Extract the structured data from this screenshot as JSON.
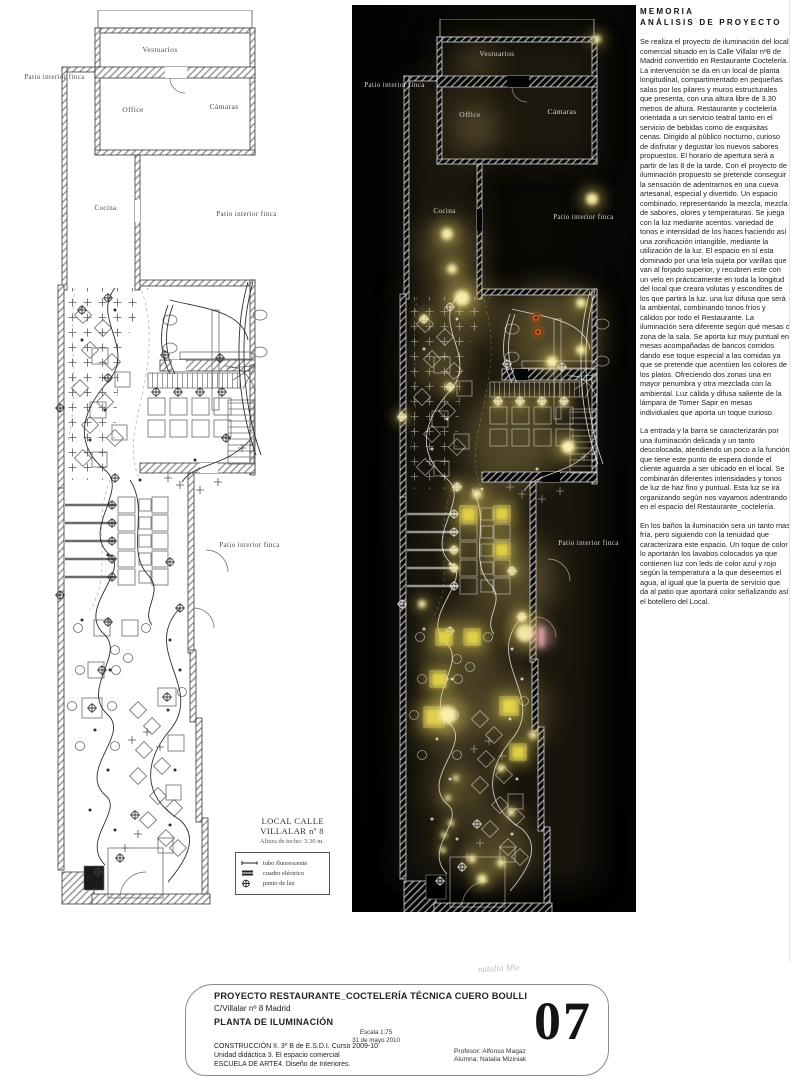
{
  "document": {
    "sheet_number": "07",
    "watermark": "natalia Miz",
    "memoria": {
      "title_line1": "MEMORIA",
      "title_line2": "ANÁLISIS DE PROYECTO",
      "paragraphs": [
        "Se realiza el proyecto de iluminación del local comercial situado en la Calle Villalar nº8 de Madrid convertido en Restaurante Coctelería. La intervención se da en un local de planta longitudinal, compartimentado en pequeñas salas por los pilares y muros estructurales que presenta, con una altura libre de 3.30 metros de altura. Restaurante y coctelería orientada a un servicio teatral tanto en el servicio de bebidas como de exquisitas cenas. Dirigido al público nocturno, curioso de disfrutar y degustar los nuevos sabores propuestos. El horario de apertura será a partir de las 8 de la tarde. Con el proyecto de iluminación propuesto se pretende conseguir la sensación de adentrarnos en una cueva artesanal, especial y divertido. Un espacio combinado, representando la mezcla, mezcla de sabores, olores y temperaturas. Se juega con la luz mediante acentos. variedad de tonos e  intensidad de los haces haciendo así una zonificación intangible, mediante la utilización de la luz. El espacio en sí esta dominado por una tela sujeta por varillas que van al forjado superior, y recubren este con un velo en prácticamente en toda la longitud del local que creara volutas y escondites de los que partirá la luz. una luz difusa que será la ambiental, combinando tonos fríos y cálidos por todo el Restaurante. La iluminación sera diferente según qué mesas o zona de la sala. Se aporta luz muy puntual en mesas acompañadas de bancos corridos dando ese toque especial a las comidas ya que se pretende que acentúen los colores de los platos. Ofreciendo dos zonas  una en mayor penumbra y otra mezclada con la ambiental. Luz cálida y difusa saliente de la lámpara de Tomer Sapir en mesas individuales que aporta un toque curioso.",
        "La entrada y la barra se caracterizarán por una iluminación delicada y un tanto descolocada, atendiendo un poco a la función que tiene este punto de espera donde el cliente aguarda a ser ubicado en el local. Se combinarán diferentes intensidades y tonos de luz de haz fino y puntual. Esta luz se irá organizando según nos vayamos adentrando en el espacio del Restaurante_coctelería.",
        "En los baños la iluminación sera un tanto mas fría, pero siguiendo con la tenuidad que caracterizara este espacio. Un toque de color lo aportarán los lavabos colocados ya que contienen luz con leds de color azul y rojo según la temperatura a la que deseemos el agua, al igual que la puerta de servicio que da al patio que aportará color señalizando así el botellero del Local."
      ]
    },
    "room_labels": {
      "vestuarios": "Vestuarios",
      "patio_interior_finca": "Patio interior finca",
      "office": "Office",
      "camaras": "Cámaras",
      "cocina": "Cocina"
    },
    "plan_caption": {
      "title": "LOCAL CALLE VILLALAR nº 8",
      "subtitle": "Altura de techo: 3.30 m."
    },
    "legend": {
      "items": [
        {
          "icon": "fluorescent-tube-icon",
          "label": "tubo fluorescente"
        },
        {
          "icon": "electrical-panel-icon",
          "label": "cuadro eléctrico"
        },
        {
          "icon": "light-point-icon",
          "label": "punto de luz"
        }
      ]
    },
    "title_block": {
      "project_title": "PROYECTO RESTAURANTE_COCTELERÍA  TÉCNICA CUERO BOULLI",
      "address": "C/Villalar nº 8  Madrid",
      "drawing_title": "PLANTA DE ILUMINACIÓN",
      "scale": "Escala 1:75",
      "date": "31 de mayo 2010",
      "course": "CONSTRUCCIÓN II.  3º B de E.S.D.I. Curso 2009-10",
      "unit": "Unidad didáctica 3. El espacio comercial",
      "school": "ESCUELA DE ARTE4. Diseño de Interiores.",
      "professor": "Profesor: Alfonso Magaz",
      "student": "Alumna:   Natalia Miziniak"
    },
    "colors": {
      "paper": "#ffffff",
      "dark_background": "#040404",
      "glow_warm": "#9c8a4e",
      "glow_bright": "#fff3b0",
      "table_light": "#e6d44a",
      "led_orange": "#b55a22",
      "door_pink": "#f0aab8",
      "ink": "#3a3a3a"
    }
  }
}
